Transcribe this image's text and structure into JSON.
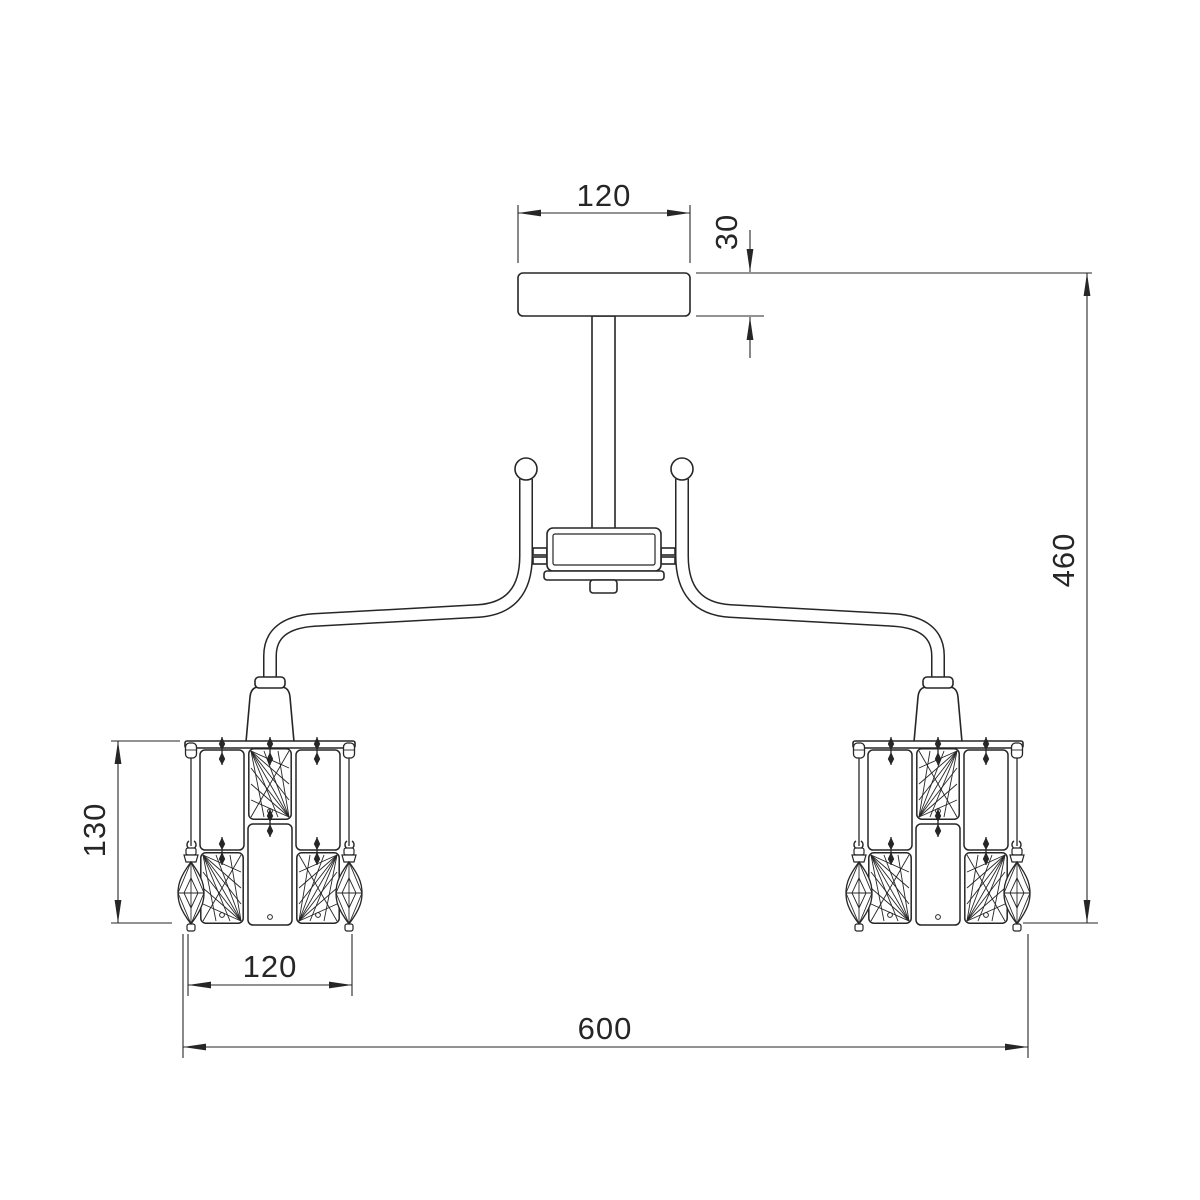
{
  "diagram": {
    "description": "Technical dimension drawing of a two-arm ceiling chandelier with rectangular crystal shades and marquise pendant drops",
    "background_color": "#ffffff",
    "line_color": "#262626",
    "dimensions": {
      "canopy_width": "120",
      "canopy_height": "30",
      "overall_height": "460",
      "shade_height": "130",
      "shade_width": "120",
      "overall_width": "600"
    }
  }
}
